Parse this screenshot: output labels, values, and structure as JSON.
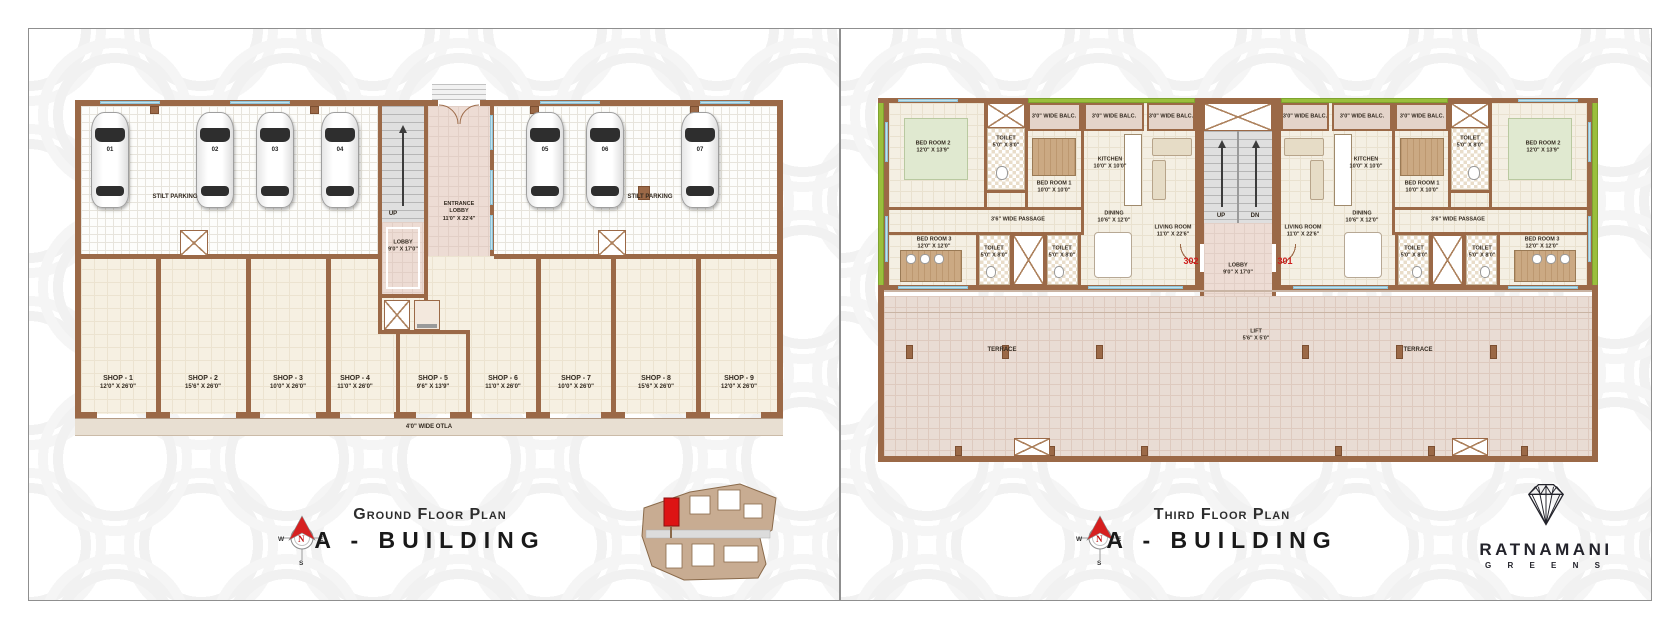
{
  "brand": {
    "name": "RATNAMANI",
    "sub": "G R E E N S"
  },
  "compass": {
    "n": "N",
    "e": "E",
    "s": "S",
    "w": "W"
  },
  "colors": {
    "wall": "#9b6947",
    "accent_red": "#ce1c1c",
    "balcony_green": "#9abf3c"
  },
  "ground": {
    "title_small": "Ground Floor Plan",
    "title_big": "A - BUILDING",
    "stilt_parking": "STILT PARKING",
    "up": "UP",
    "lobby": {
      "name": "LOBBY",
      "dim": "9'0\" X 17'0\""
    },
    "entrance_lobby": {
      "name": "ENTRANCE LOBBY",
      "dim": "11'0\" X 22'4\""
    },
    "otla": "4'0\" WIDE OTLA",
    "cars": [
      "01",
      "02",
      "03",
      "04",
      "05",
      "06",
      "07"
    ],
    "shops": [
      {
        "name": "SHOP - 1",
        "dim": "12'0\" X 26'0\""
      },
      {
        "name": "SHOP - 2",
        "dim": "15'6\" X 26'0\""
      },
      {
        "name": "SHOP - 3",
        "dim": "10'0\" X 26'0\""
      },
      {
        "name": "SHOP - 4",
        "dim": "11'0\" X 26'0\""
      },
      {
        "name": "SHOP - 5",
        "dim": "9'6\" X 13'9\""
      },
      {
        "name": "SHOP - 6",
        "dim": "11'0\" X 26'0\""
      },
      {
        "name": "SHOP - 7",
        "dim": "10'0\" X 26'0\""
      },
      {
        "name": "SHOP - 8",
        "dim": "15'6\" X 26'0\""
      },
      {
        "name": "SHOP - 9",
        "dim": "12'0\" X 26'0\""
      }
    ]
  },
  "third": {
    "title_small": "Third Floor Plan",
    "title_big": "A - BUILDING",
    "balc": "3'0\" WIDE BALC.",
    "passage": "3'6\" WIDE PASSAGE",
    "rooms": {
      "bed1": {
        "name": "BED ROOM 1",
        "dim": "10'0\" X 10'0\""
      },
      "bed2": {
        "name": "BED ROOM 2",
        "dim": "12'0\" X 13'9\""
      },
      "bed3": {
        "name": "BED ROOM 3",
        "dim": "12'0\" X 12'0\""
      },
      "kitchen": {
        "name": "KITCHEN",
        "dim": "10'0\" X 10'0\""
      },
      "dining": {
        "name": "DINING",
        "dim": "10'6\" X 12'0\""
      },
      "living": {
        "name": "LIVING ROOM",
        "dim": "11'0\" X 22'6\""
      },
      "toilet": {
        "name": "TOILET",
        "dim": "5'0\" X 8'0\""
      }
    },
    "lobby": {
      "name": "LOBBY",
      "dim": "9'0\" X 17'0\""
    },
    "lift": {
      "name": "LIFT",
      "dim": "5'6\" X 5'0\""
    },
    "stair_up": "UP",
    "stair_dn": "DN",
    "units": {
      "left": "302",
      "right": "301"
    },
    "terrace": "TERRACE"
  }
}
